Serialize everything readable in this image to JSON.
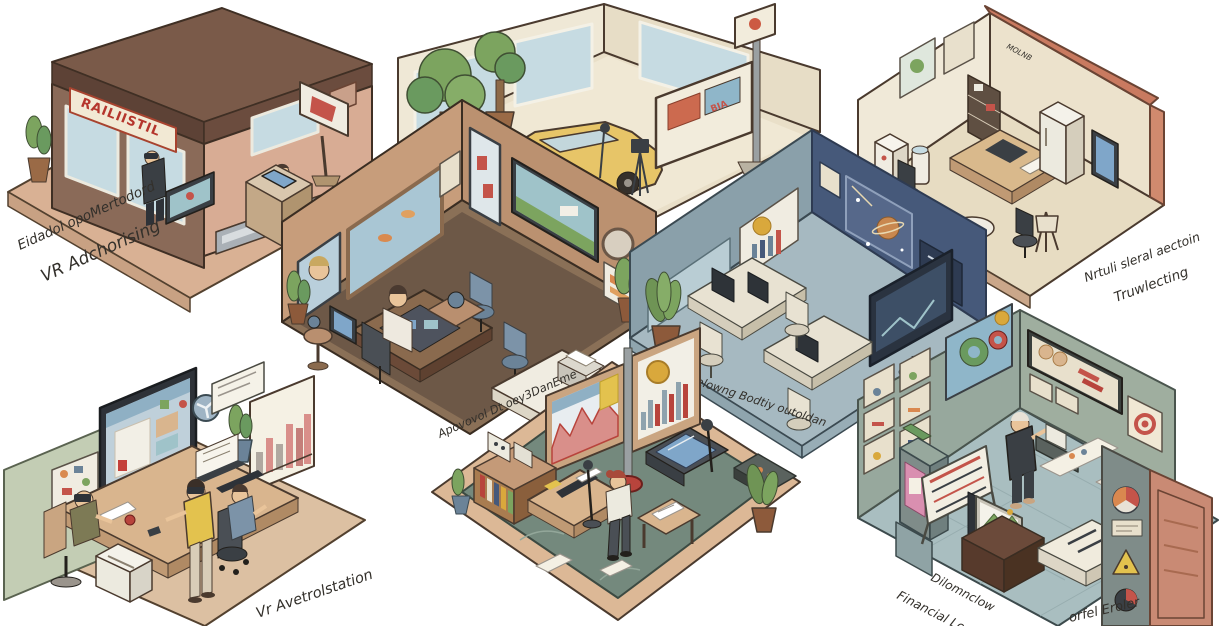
{
  "scene": {
    "width": 1224,
    "height": 626,
    "background": "#ffffff",
    "style": "hand-drawn isometric illustration of eight room vignettes"
  },
  "rooms": {
    "storefront": {
      "name": "VR advertising storefront",
      "sign": "RAILIISTIL",
      "caption_line1": "Eidadol opoMertodord",
      "caption_line2": "VR Adchorising"
    },
    "car_showroom": {
      "name": "car showroom with billboard",
      "billboard": "BIA"
    },
    "tech_lab": {
      "name": "digital headset lab",
      "wall_text": "MOLNB",
      "caption_left": "Diyifalen Nedsant",
      "caption_right_line1": "Nrtuli sleral aectoin",
      "caption_right_line2": "Truwlecting"
    },
    "brown_office": {
      "name": "monitoring office",
      "caption": "Apovovol Dt oey3DanEme"
    },
    "blue_office": {
      "name": "open-plan blue office",
      "caption": "Belowng Bodtiy outoldan"
    },
    "vr_workstation": {
      "name": "VR workstation room",
      "caption": "Vr Avetrolstation"
    },
    "green_studio": {
      "name": "analytics studio"
    },
    "financial_gallery": {
      "name": "financial showroom",
      "caption_line1": "Dilomnclow",
      "caption_line2": "Financial Loun",
      "caption_right": "orfel Eroler"
    }
  },
  "palette": {
    "background": "#ffffff",
    "outline": "#4a3a2e",
    "floor_tan": "#d9b596",
    "wall_cream": "#efe8d6",
    "wall_sage": "#c3cdb4",
    "wall_brown": "#c49a78",
    "wall_slate": "#8aa0aa",
    "wall_navy": "#46597a",
    "wall_teal_gray": "#97a89d",
    "floor_brown": "#6d5847",
    "floor_bluegray": "#a6b9c1",
    "floor_green": "#74897d",
    "floor_teal": "#a9bec0",
    "accent_red": "#b8443c",
    "accent_salmon": "#d08a6e",
    "accent_yellow": "#e3c24e",
    "car_yellow": "#e7c568",
    "plant_green": "#7ca45f",
    "screen_blue": "#9fc3c9",
    "ink": "#33302b"
  }
}
